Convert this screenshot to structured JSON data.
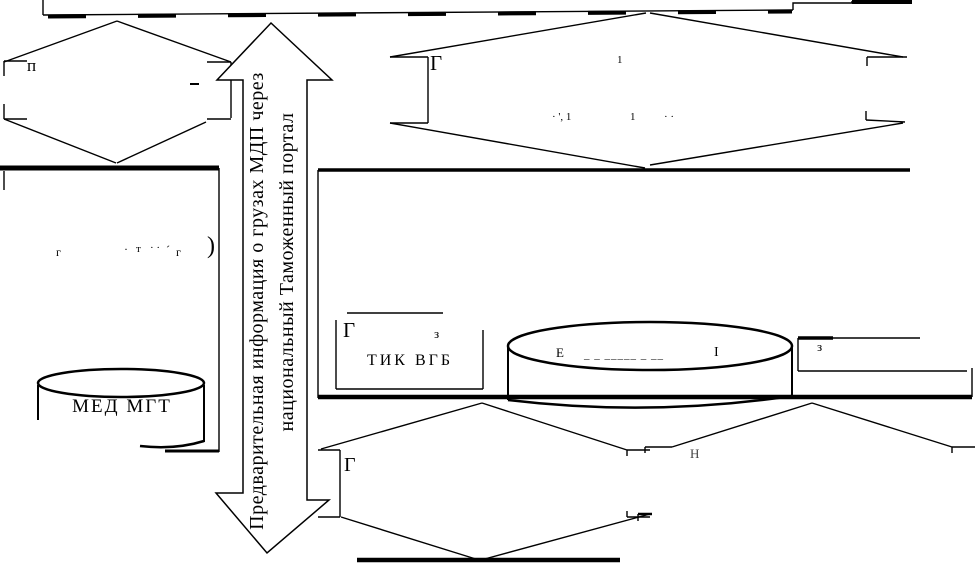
{
  "diagram": {
    "central_arrow": {
      "label_line1": "Предварительная информация о грузах МДП через",
      "label_line2": "национальный Таможенный портал"
    },
    "left_diamond": {
      "label": "п"
    },
    "left_rect": {
      "fragments": [
        "г",
        "·",
        "т",
        "· ·",
        "´",
        "г",
        ")"
      ]
    },
    "left_cylinder": {
      "label": "МЕД МГТ"
    },
    "top_right_diamond": {
      "label": "Г",
      "fragments": [
        "1",
        "· ', 1",
        "1",
        "· ·"
      ]
    },
    "inner_rect": {
      "corner_label": "Г",
      "side_label": "з",
      "label": "ТИК ВГБ"
    },
    "main_cylinder": {
      "fragments": [
        "Е",
        "_ _ _____ _ __",
        "І"
      ]
    },
    "side_rect": {
      "label": "з"
    },
    "bottom_center_diamond": {
      "label": "Г"
    },
    "bottom_right_diamond": {
      "label": "Н"
    }
  }
}
